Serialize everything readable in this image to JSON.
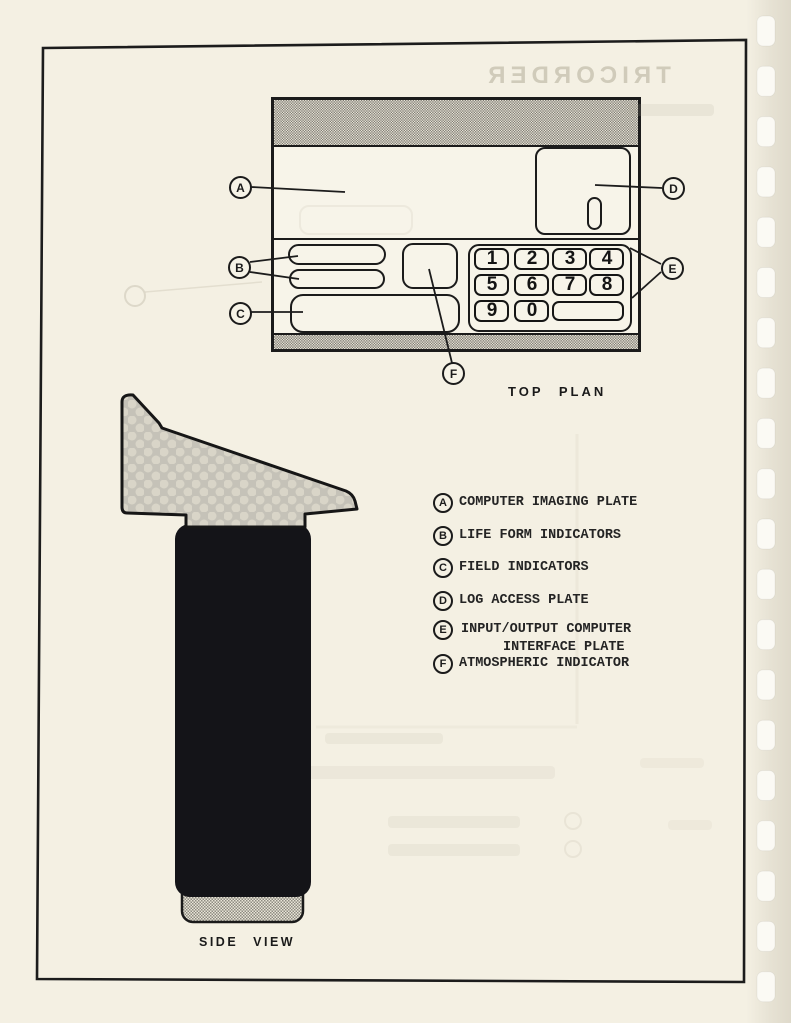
{
  "document": {
    "ghost_title": "TRICORDER",
    "labels": {
      "top_plan": "TOP PLAN",
      "side_view": "SIDE VIEW"
    }
  },
  "top_plan": {
    "callouts": {
      "a": "A",
      "b": "B",
      "c": "C",
      "d": "D",
      "e": "E",
      "f": "F"
    },
    "keypad": {
      "keys": [
        "1",
        "2",
        "3",
        "4",
        "5",
        "6",
        "7",
        "8",
        "9",
        "0",
        ""
      ]
    }
  },
  "legend": {
    "items": [
      {
        "letter": "A",
        "label": "COMPUTER IMAGING PLATE"
      },
      {
        "letter": "B",
        "label": "LIFE FORM INDICATORS"
      },
      {
        "letter": "C",
        "label": "FIELD INDICATORS"
      },
      {
        "letter": "D",
        "label": "LOG ACCESS PLATE"
      },
      {
        "letter": "E",
        "label": "INPUT/OUTPUT COMPUTER",
        "label_line2": "INTERFACE PLATE"
      },
      {
        "letter": "F",
        "label": "ATMOSPHERIC INDICATOR"
      }
    ]
  },
  "colors": {
    "paper": "#f4f0e3",
    "ink": "#1b1b1b",
    "halftone": "#c5c2b8"
  }
}
